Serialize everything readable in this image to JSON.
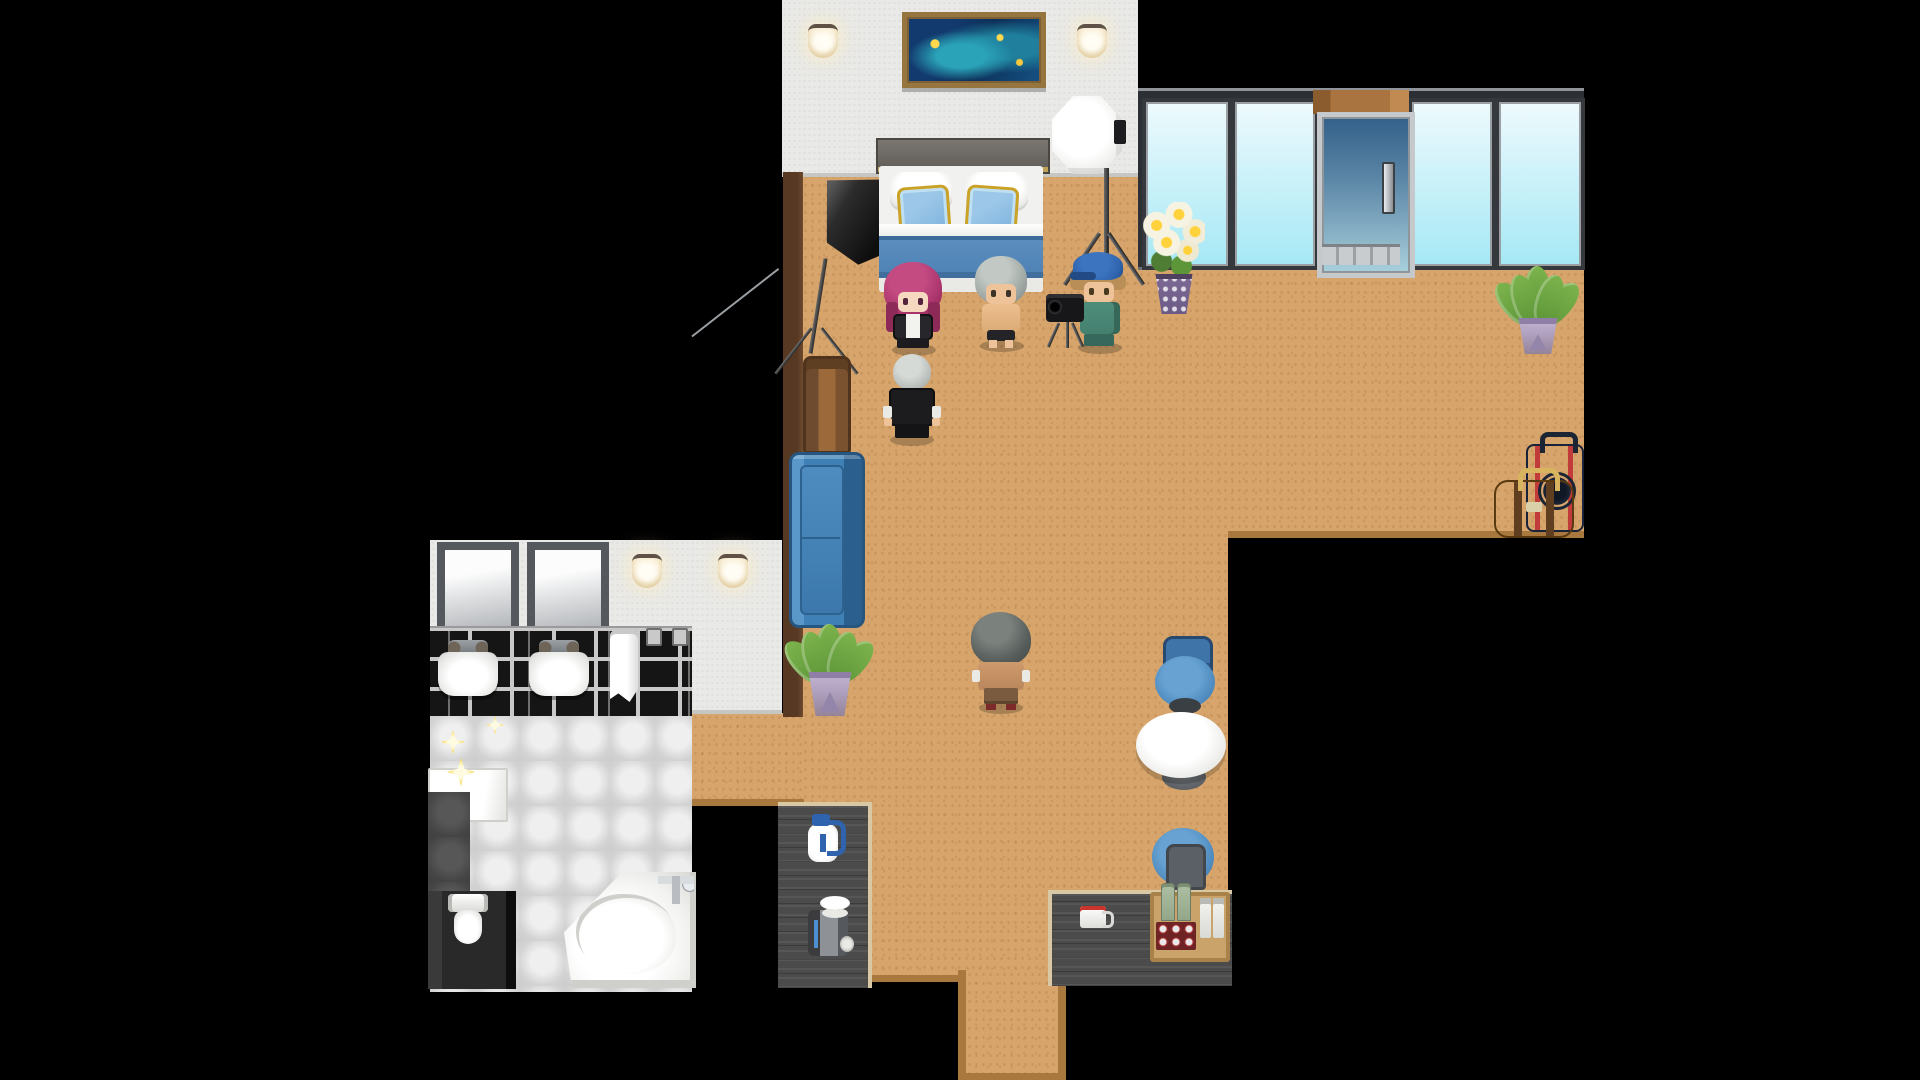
{
  "app": {
    "title": "Top-down pixel RPG hotel suite scene (photo-shoot in progress)",
    "genre": "rpg-maker-style interior map"
  },
  "palette": {
    "background": "#000000",
    "floor": "#d7a56b",
    "floor_edge": "#a9783f",
    "wall": "#e9e9e7",
    "brown_wall": "#573823",
    "window_glass_top": "#eefafd",
    "window_glass_bottom": "#a5e8f5",
    "window_frame": "#2c2f33",
    "door_glass_top": "#33608a",
    "door_glass_bottom": "#a9d0dc",
    "door_frame": "#c6c9cc",
    "wood_lintel": "#a9743f",
    "sofa": "#3f80b6",
    "sofa_dark": "#2a5f8e",
    "chair": "#4a86bb",
    "table_top": "#f4f4f2",
    "counter": "#4b4b4b",
    "counter_trim": "#d8c8a4",
    "bed_blanket": "#4e81b4",
    "bed_pillow": "#7db3de",
    "pillow_trim": "#c9a227",
    "brick_black": "#151515",
    "grout": "#c9c9c9",
    "tile_light": "#dcdcdc",
    "tile_dark": "#4a4a4a",
    "plant_green": "#7cb34d",
    "plant_pot": "#b2a3c2",
    "flower_vase": "#6c5a86",
    "sparkle": "#f5d545",
    "hair_magenta": "#a8336a",
    "hair_silver": "#9aa39f",
    "hair_gray_dark": "#575d5a",
    "cap_blue": "#2f63ad",
    "outfit_teal": "#45806f",
    "suit_black": "#1c1c1e",
    "skin": "#eec39a",
    "luggage_navy": "#2e3d55",
    "luggage_red": "#c23b3b",
    "bag_brown": "#8a6134",
    "tray_wood": "#caa36a"
  },
  "rooms": [
    {
      "id": "bedroom",
      "label": "bedroom with double bed and photo lighting rigs"
    },
    {
      "id": "living-area",
      "label": "open living area with sofa, table and chairs"
    },
    {
      "id": "balcony-wall",
      "label": "glass window wall with sliding door"
    },
    {
      "id": "bathroom",
      "label": "tiled bathroom with twin sinks, toilet and corner tub"
    },
    {
      "id": "hallway",
      "label": "hallway connecting bathroom to living area"
    },
    {
      "id": "kitchenette",
      "label": "dark counters with drinks and coffee gear"
    }
  ],
  "characters": [
    {
      "id": "woman-magenta-hair",
      "facing": "down",
      "description": "woman with long magenta hair, black jacket over white top"
    },
    {
      "id": "man-silver-shirtless",
      "facing": "down",
      "description": "shirtless man with silver hair and dark briefs"
    },
    {
      "id": "photographer-blue-cap",
      "facing": "down",
      "description": "man in blue cap and teal outfit holding camera on mini tripod"
    },
    {
      "id": "man-bald-suit",
      "facing": "up",
      "description": "bald man in black suit with white cuffs"
    },
    {
      "id": "man-gray-shaggy",
      "facing": "up",
      "description": "shirtless man with shaggy dark-gray hair and brown trousers"
    }
  ],
  "props": [
    "double-bed-blue-pillows",
    "framed-aquarium-painting",
    "wall-lamp x4",
    "white-octagon-softbox-on-stand",
    "black-softbox-on-stand",
    "video-camera-mini-tripod",
    "lily-bouquet-in-purple-vase",
    "blue-sofa",
    "leather-backpack",
    "potted-plant x2",
    "round-white-table",
    "blue-chair x2",
    "water-jug",
    "coffee-machine-with-cups",
    "coffee-mug",
    "minibar-tray-bottles",
    "navy-suitcase",
    "brown-duffel-bag",
    "twin-mirrors",
    "twin-sinks",
    "hand-towel",
    "wall-hooks",
    "white-shelf",
    "toilet",
    "corner-bathtub",
    "sparkle-clean-effects"
  ]
}
